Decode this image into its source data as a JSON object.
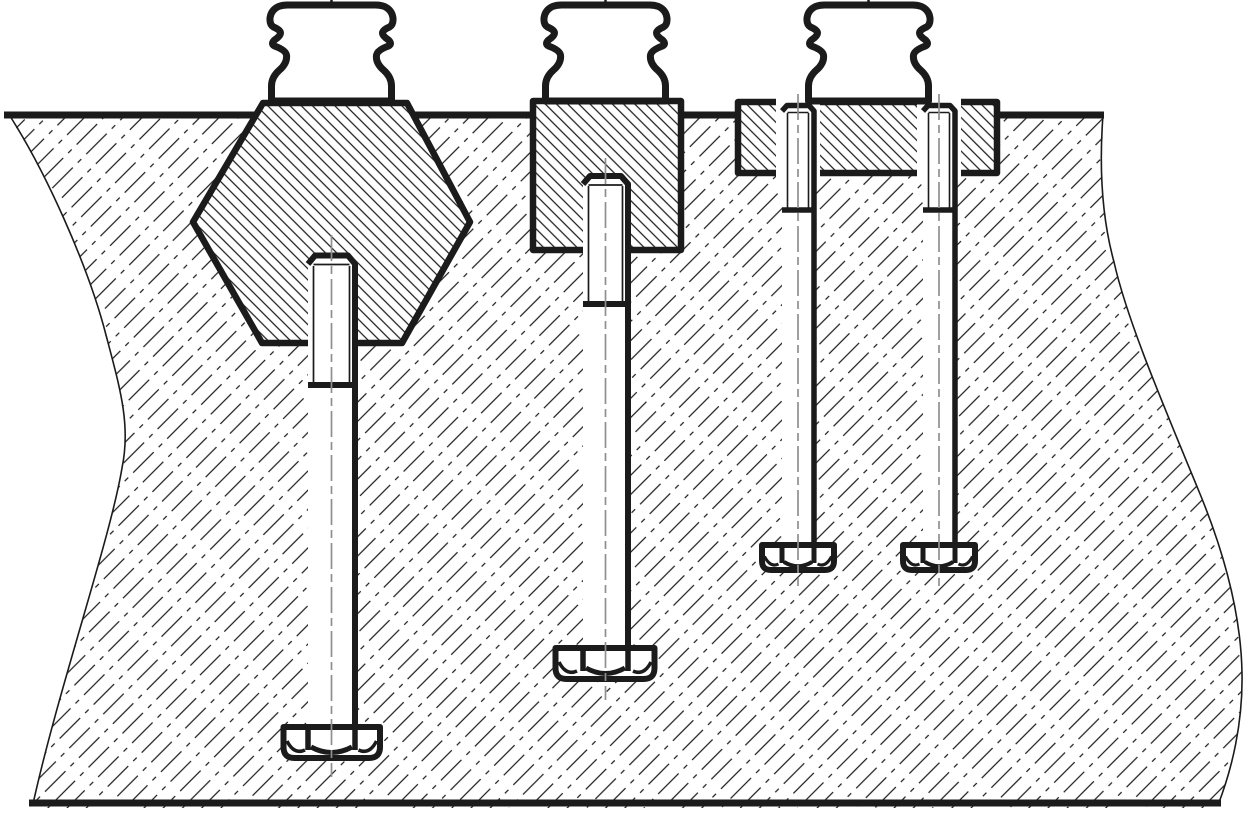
{
  "meta": {
    "aria_label": "Engineering cross-section drawing: three fastening arrangements in a sectioned base block — a hex nut with threaded stud, a square nut with threaded stud, and a recessed rectangular plate held by two hex-head bolts, each topped by a knurled clamping knob"
  },
  "canvas": {
    "width": 1246,
    "height": 815
  },
  "colors": {
    "line": "#1b1b1b",
    "centerline": "#8f8f8f",
    "background": "#ffffff"
  },
  "hatching": {
    "base_block": "dash-dot thin lines, 45 degrees rising to the right, ~19 px pitch",
    "fitted_parts": "continuous thin lines, 45 degrees falling to the right, ~11 px pitch"
  },
  "components": [
    {
      "id": "base-block-section",
      "label": "sectioned base block with freehand break lines left and right"
    },
    {
      "id": "hex-nut-assembly",
      "label": "hex nut sunk in counterbore, threaded stud with hex head below, clamping knob on top"
    },
    {
      "id": "square-nut-assembly",
      "label": "square nut sunk in counterbore, threaded stud with hex head below, clamping knob on top"
    },
    {
      "id": "bolted-plate-assembly",
      "label": "rectangular plate recessed in slot, two hex-head through-bolts, clamping knob on top"
    }
  ]
}
